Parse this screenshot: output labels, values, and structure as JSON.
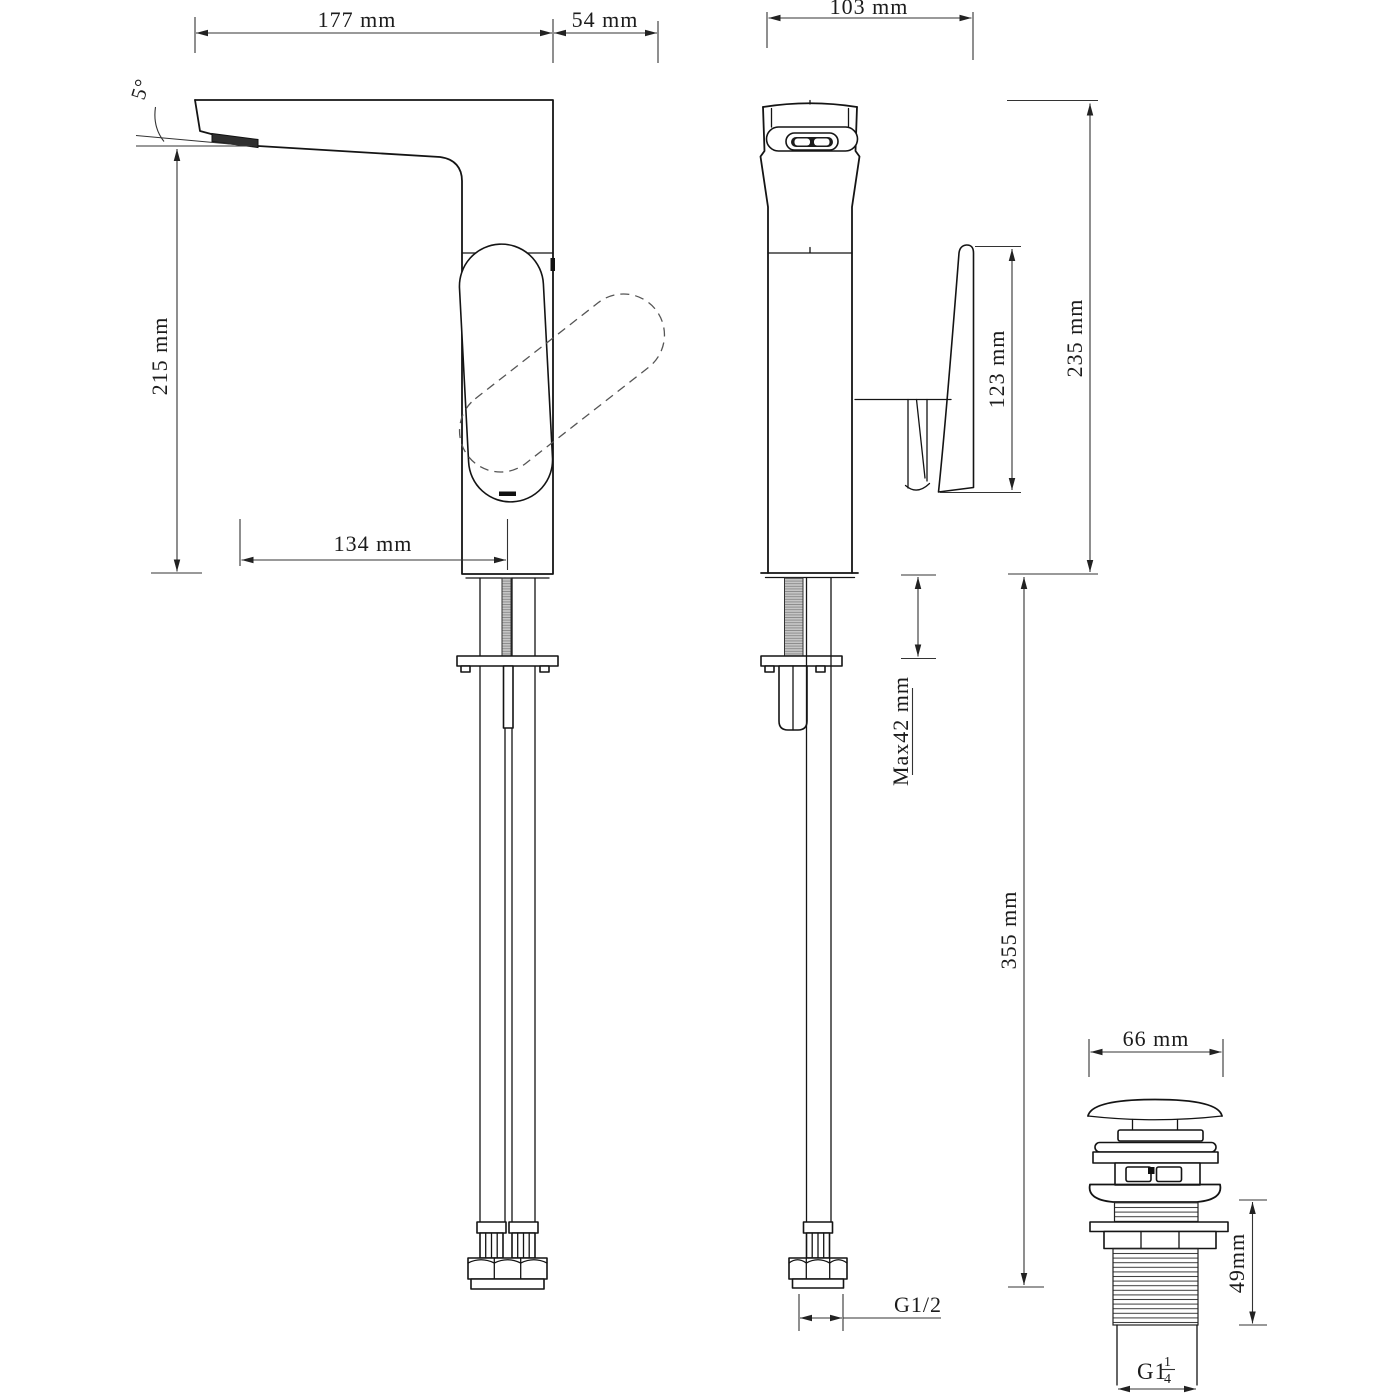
{
  "page": {
    "background": "#ffffff",
    "line_color": "#141414",
    "dim_color": "#333333"
  },
  "drawing": {
    "kind": "basin mixer tap dimensional drawing",
    "side_view": {
      "dims": {
        "spout_reach": "177 mm",
        "handle_clearance": "54 mm",
        "spout_angle": "5°",
        "spout_height": "215 mm",
        "spout_projection": "134 mm"
      }
    },
    "front_view": {
      "dims": {
        "body_depth": "103 mm",
        "total_height": "235 mm",
        "handle_height": "123 mm",
        "max_deck_thickness": "Max42 mm",
        "hose_length": "355 mm",
        "hose_thread": "G1/2"
      }
    },
    "waste_view": {
      "dims": {
        "cap_diameter": "66 mm",
        "thread_length": "49mm",
        "thread_size_main": "G1",
        "thread_size_numerator": "1",
        "thread_size_denominator": "4"
      }
    }
  }
}
